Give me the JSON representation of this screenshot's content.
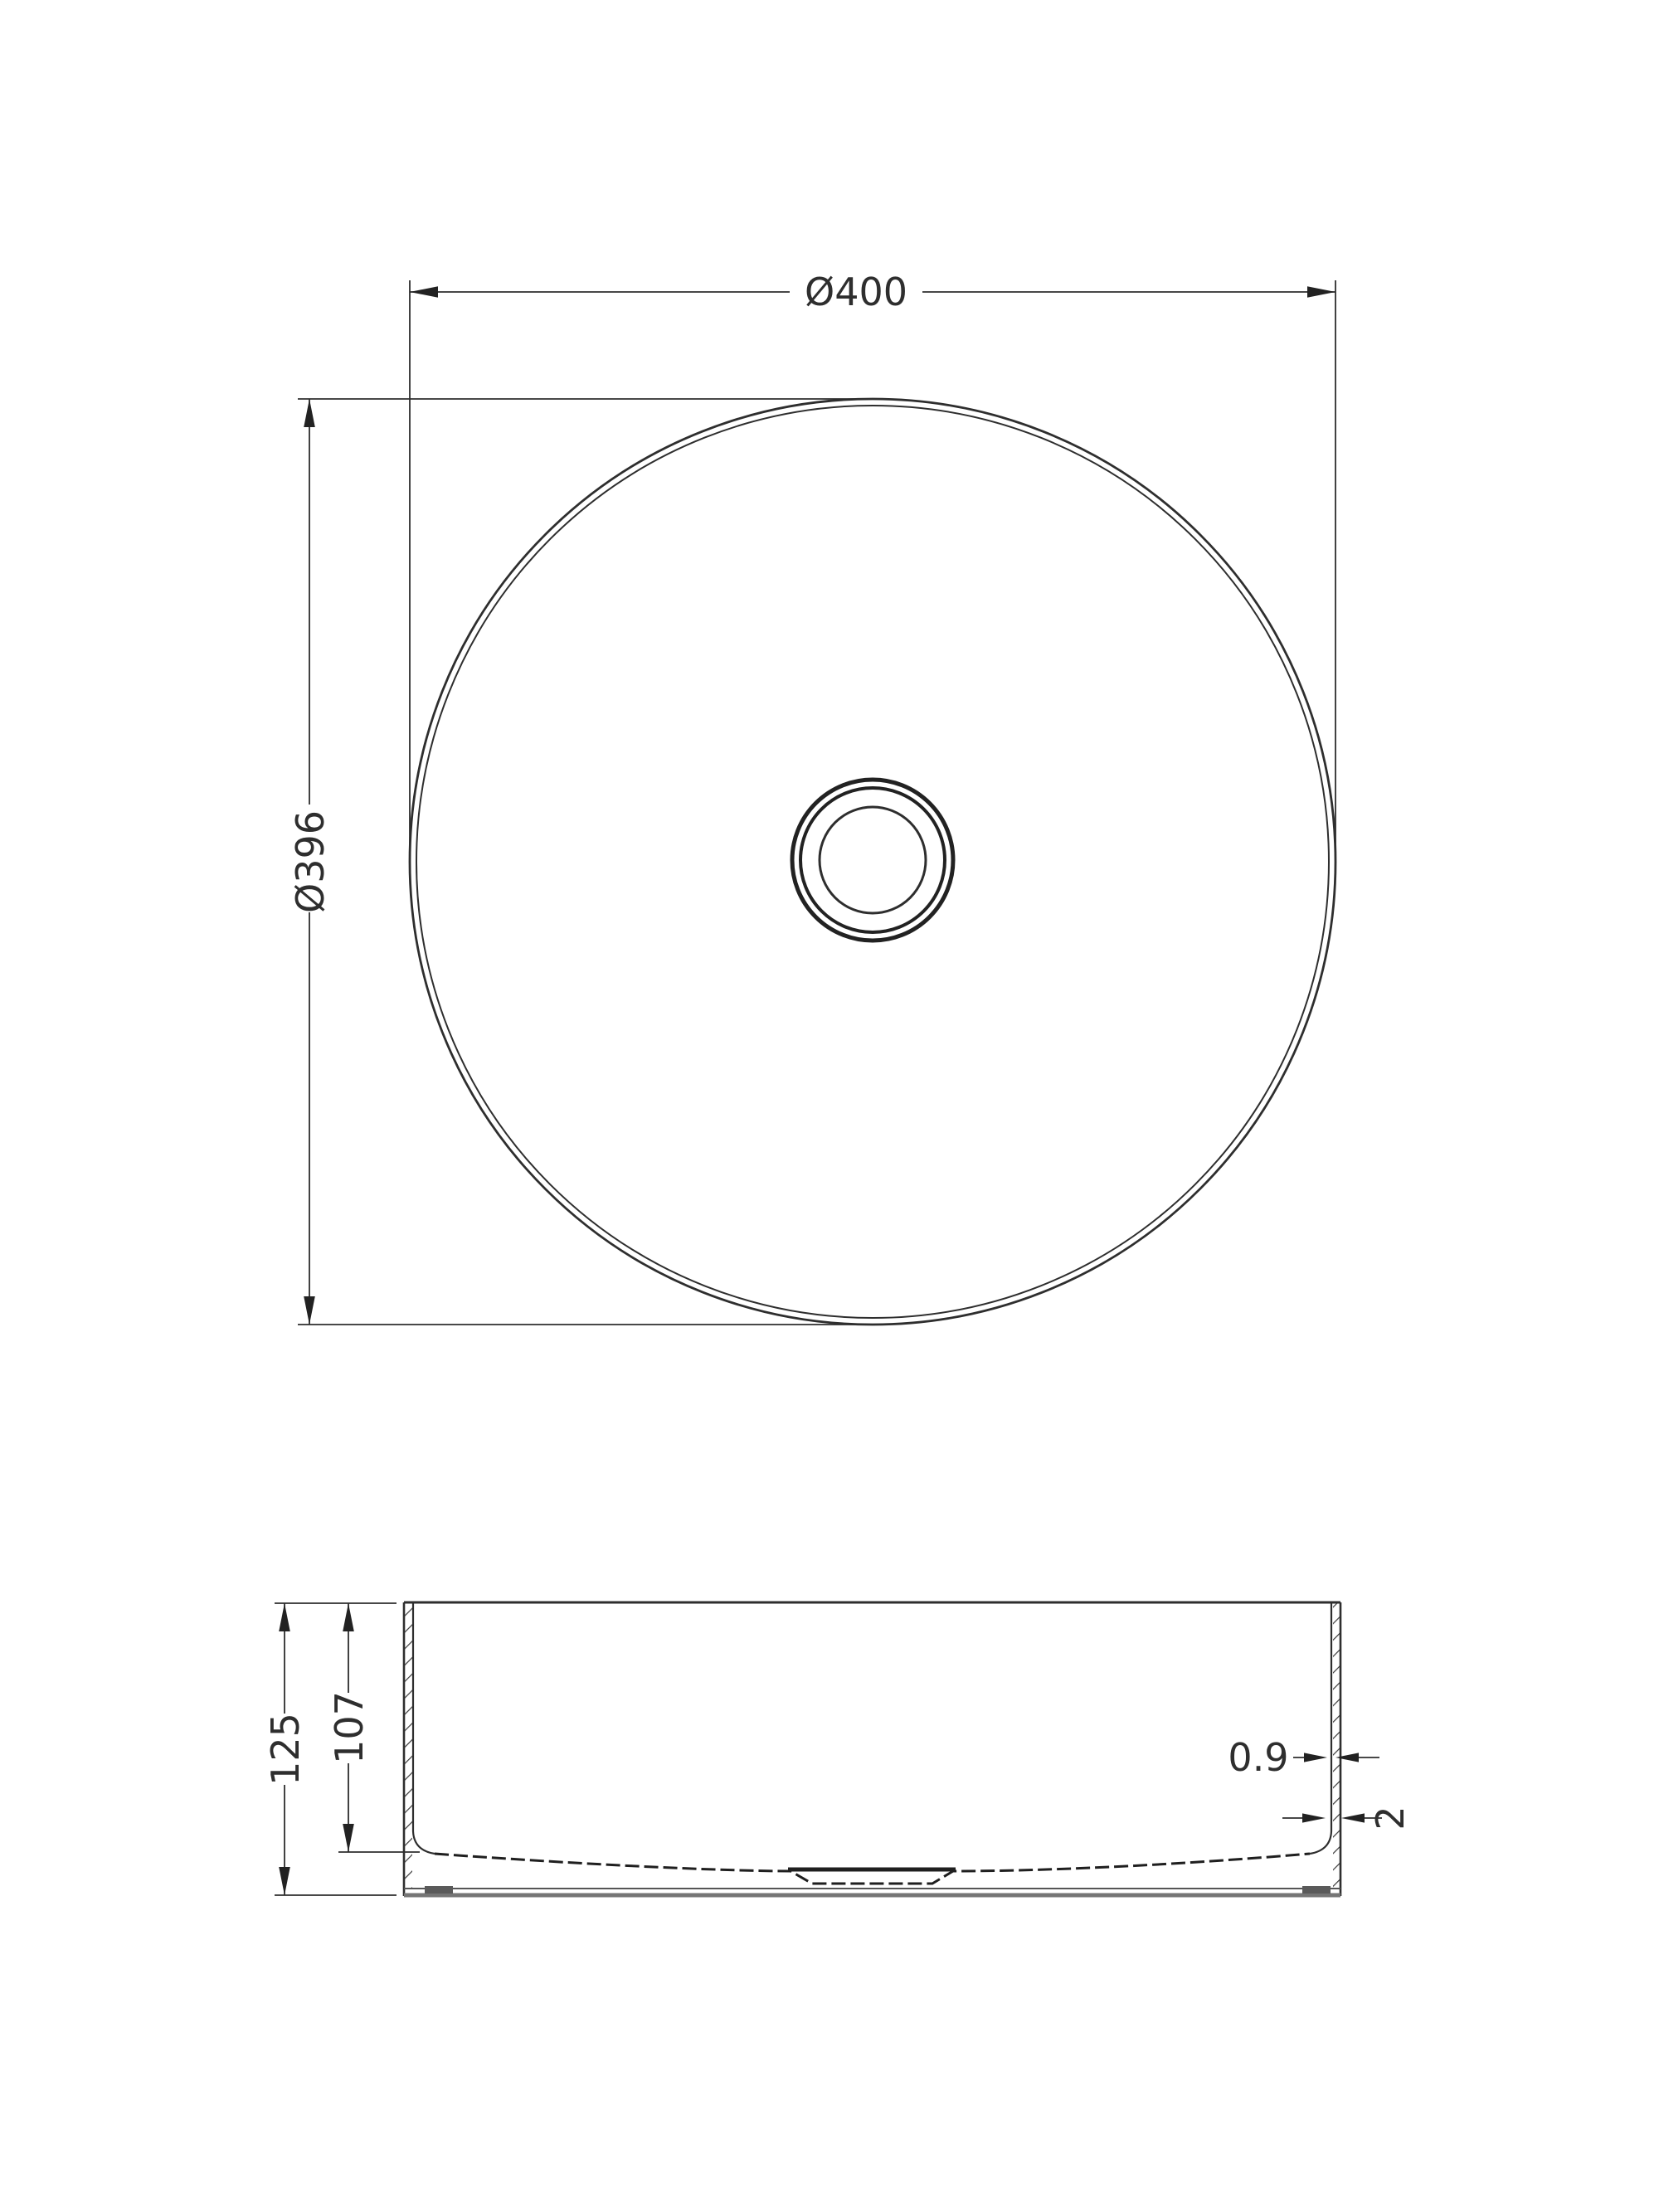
{
  "document": {
    "type": "technical drawing",
    "subject": "round countertop basin, plan view and section view",
    "background_color": "#ffffff",
    "line_color": "#2e2e2e",
    "bottom_band_color": "#757575"
  },
  "top_view": {
    "dim_outer_diameter": "Ø400",
    "dim_inner_diameter": "Ø396"
  },
  "side_view": {
    "dim_overall_height": "125",
    "dim_inner_depth": "107",
    "dim_wall_thickness_upper": "0.9",
    "dim_wall_thickness_lower": "2"
  }
}
